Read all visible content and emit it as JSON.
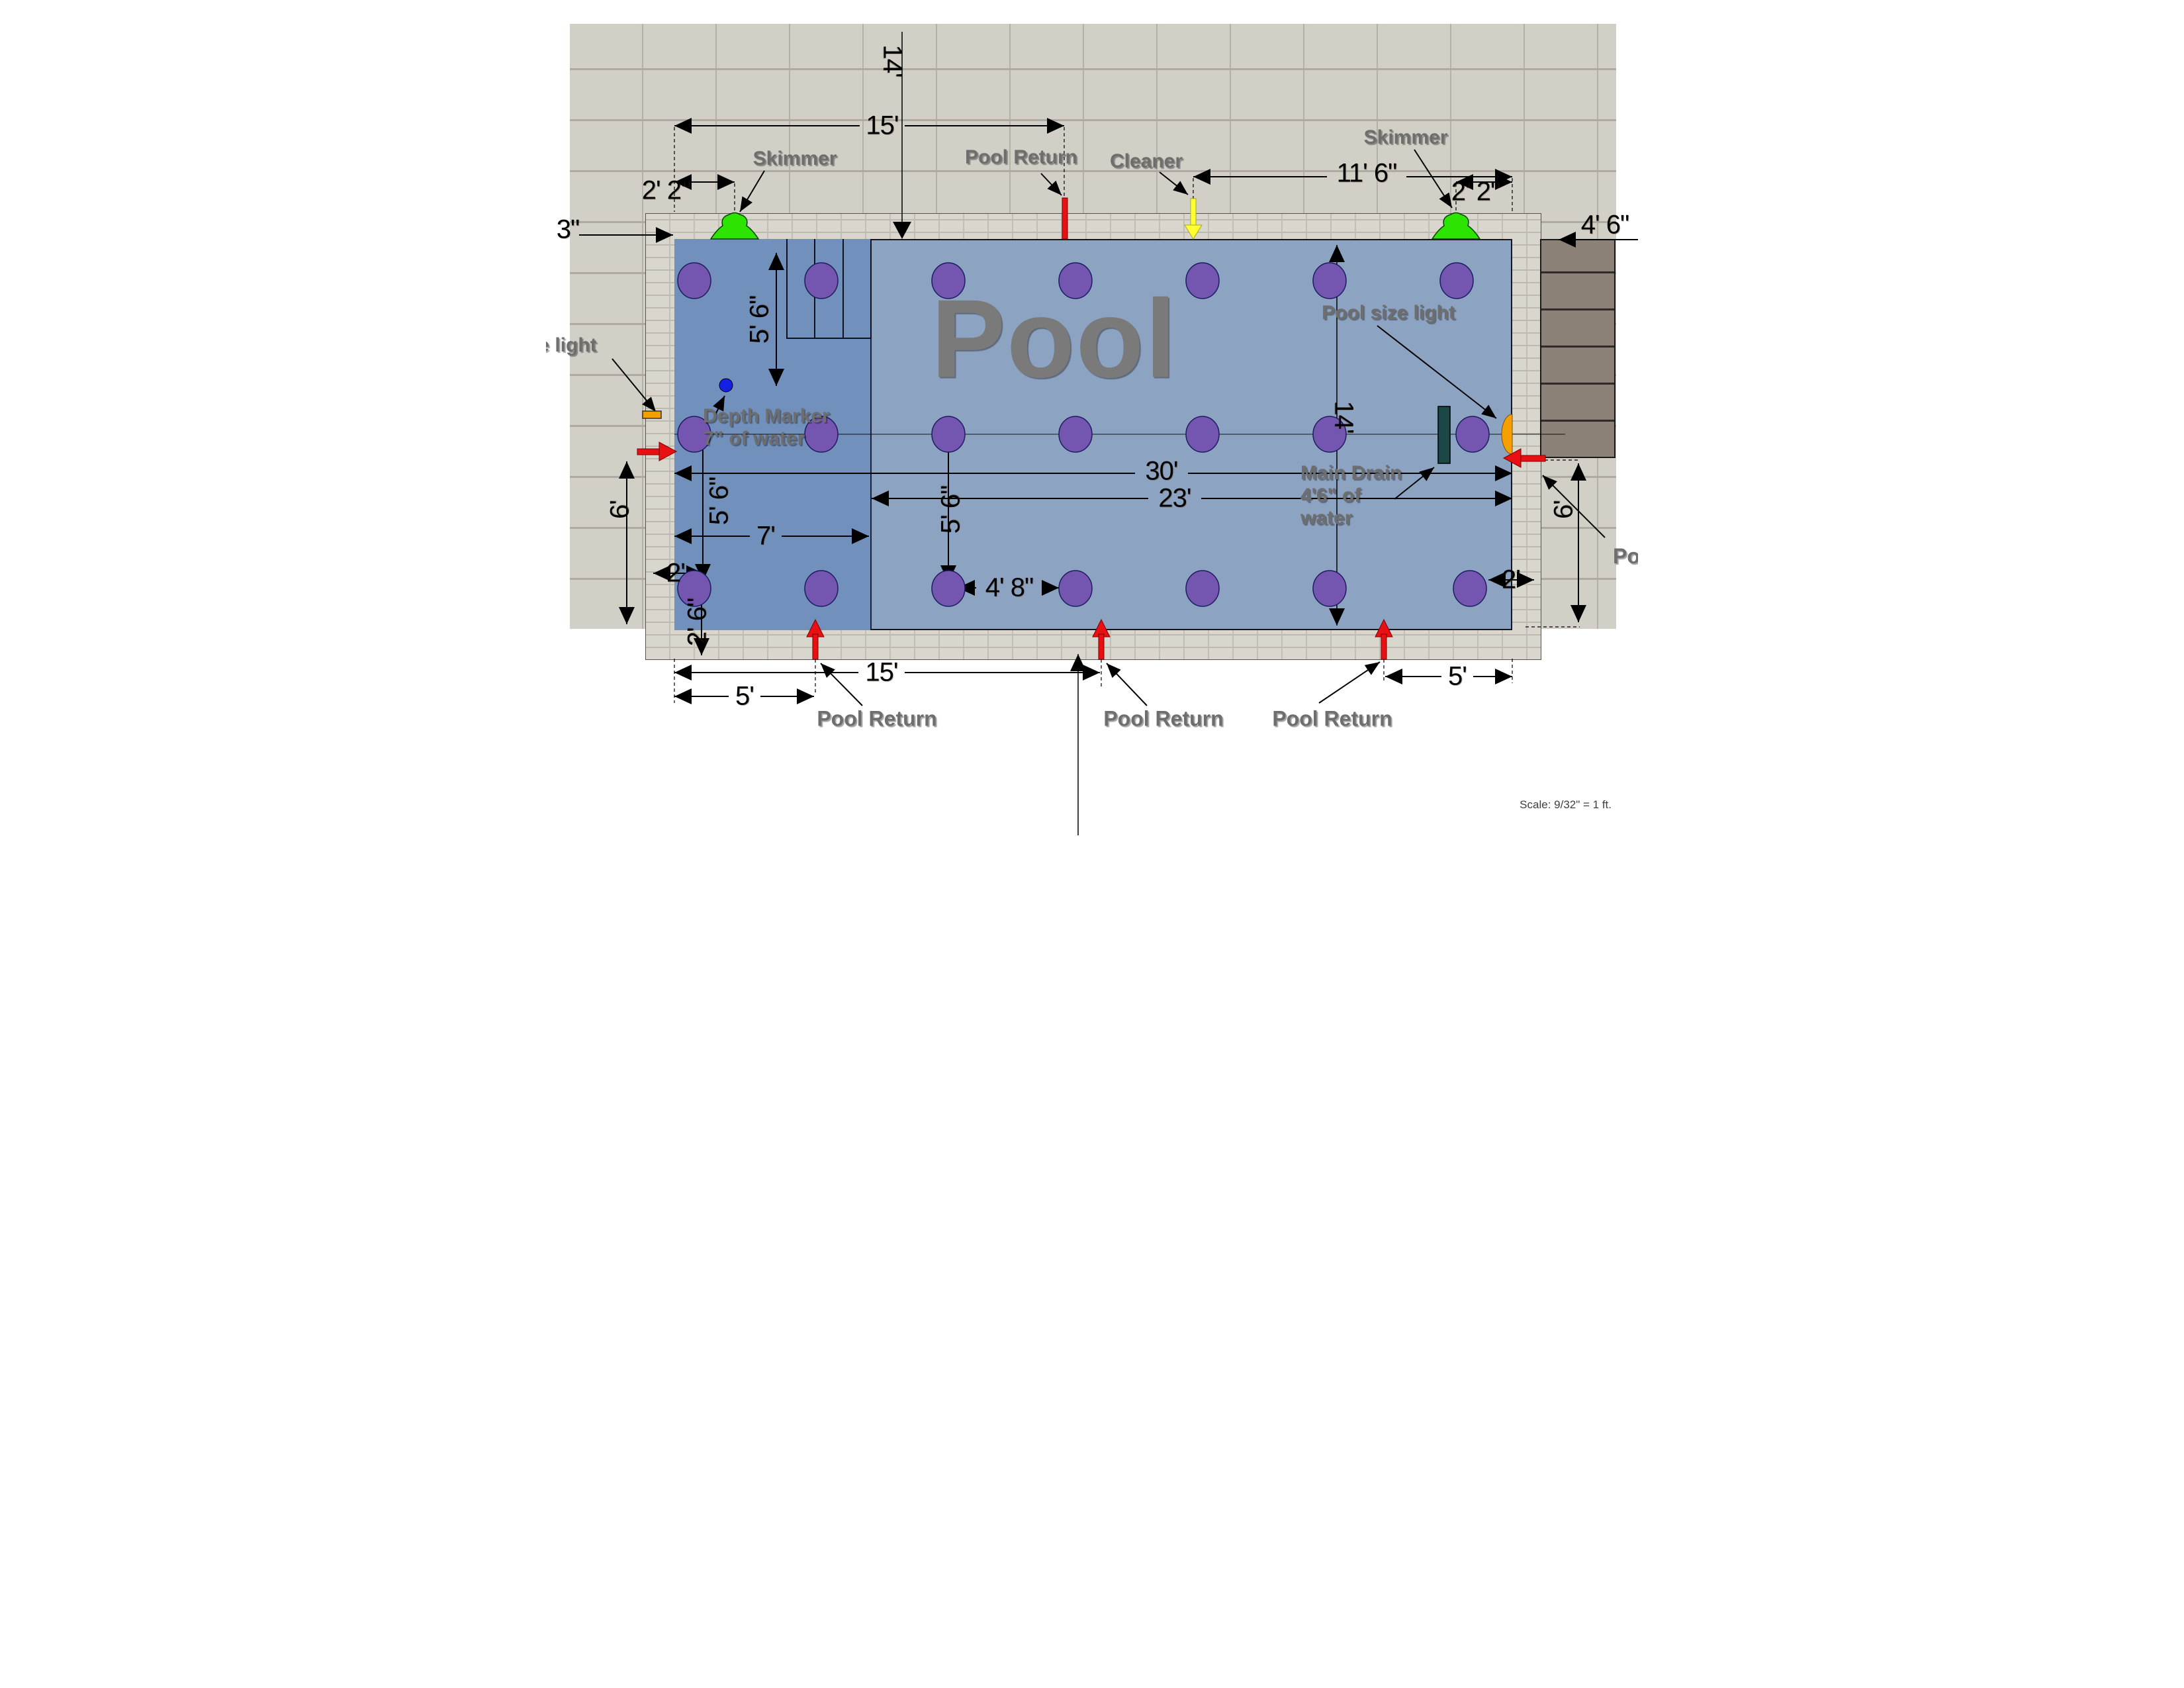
{
  "page": {
    "scale_note": "Scale: 9/32\" = 1 ft."
  },
  "pool": {
    "title": "Pool"
  },
  "labels": {
    "skimmer_left": "Skimmer",
    "skimmer_right": "Skimmer",
    "pool_return_top": "Pool Return",
    "cleaner": "Cleaner",
    "pool_size_light": "Pool size light",
    "light_left_cut": "pe light",
    "depth_marker_line1": "Depth Marker",
    "depth_marker_line2": "7\" of water",
    "main_drain_line1": "Main Drain",
    "main_drain_line2": "4'6\" of",
    "main_drain_line3": "water",
    "pool_return_bottom1": "Pool Return",
    "pool_return_bottom2": "Pool Return",
    "pool_return_bottom3": "Pool Return",
    "pool_return_right_cut": "Po"
  },
  "dims": {
    "top_offset_14": "14'",
    "top_15": "15'",
    "skimmer_left_offset": "2' 2\"",
    "skimmer_right_offset": "2' 2\"",
    "cleaner_offset": "11' 6\"",
    "left_3in": "3\"",
    "upper_left_5_6": "5' 6\"",
    "lower_left_5_6": "5' 6\"",
    "center_5_6": "5' 6\"",
    "left_6": "6'",
    "right_6": "6'",
    "left_2": "2'",
    "right_2": "2'",
    "corner_2_6": "2' 6\"",
    "shallow_7": "7'",
    "length_30": "30'",
    "deep_23": "23'",
    "dot_gap_4_8": "4' 8\"",
    "width_14": "14'",
    "stairs_4_6": "4' 6\"",
    "bottom_15": "15'",
    "bottom_5_left": "5'",
    "bottom_5_right": "5'"
  }
}
